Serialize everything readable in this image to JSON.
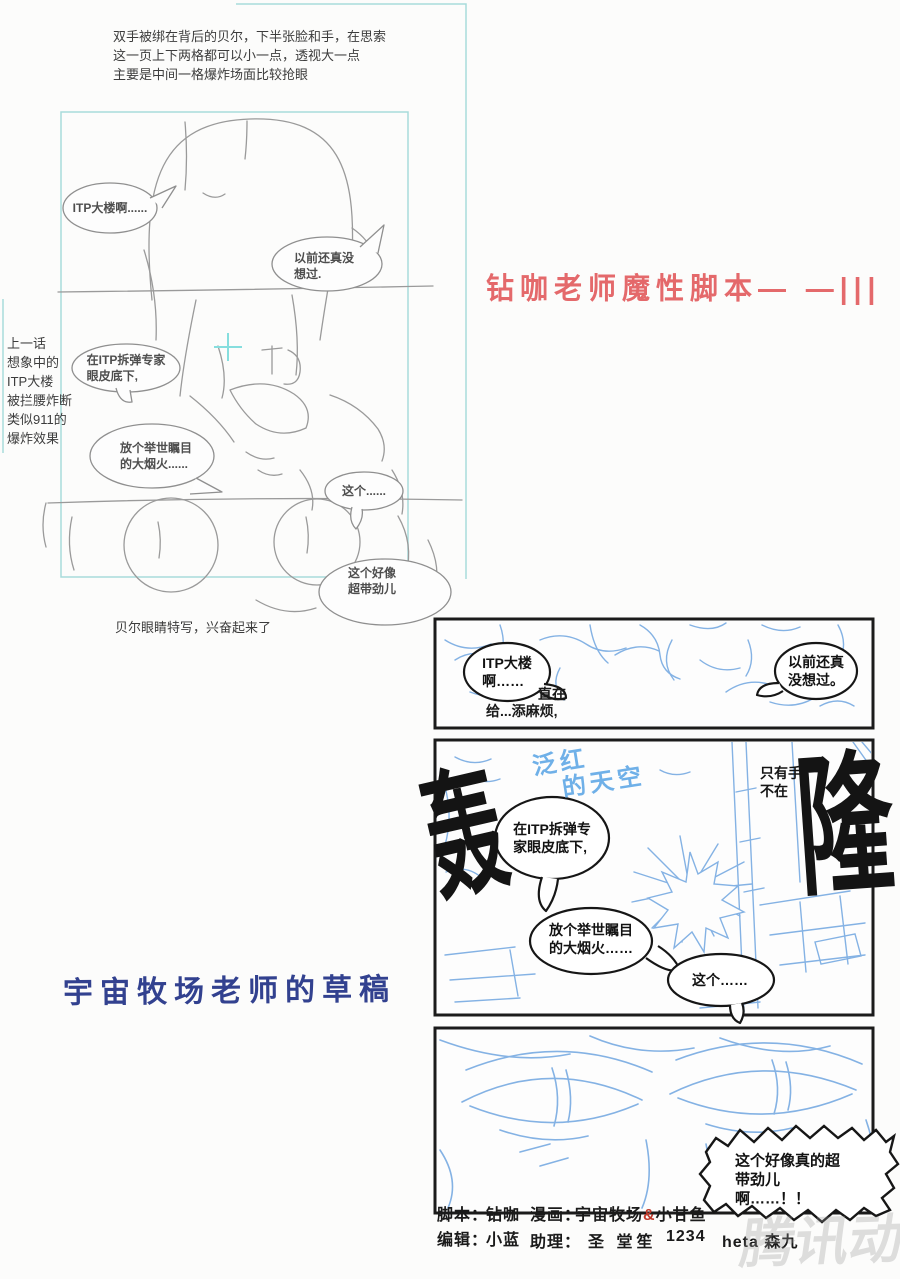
{
  "notes": {
    "top_lines": "双手被绑在背后的贝尔，下半张脸和手，在思索\n这一页上下两格都可以小一点，透视大一点\n主要是中间一格爆炸场面比较抢眼",
    "left_lines": "上一话\n想象中的\nITP大楼\n被拦腰炸断\n类似911的\n爆炸效果",
    "caption": "贝尔眼睛特写，兴奋起来了"
  },
  "titles": {
    "script_title": "钻咖老师魔性脚本— —|||",
    "draft_title": "宇宙牧场老师的草稿"
  },
  "storyboard": {
    "bubble_itp": "ITP大楼啊......",
    "bubble_never": "以前还真没\n想过.",
    "bubble_expert": "在ITP拆弹专家\n眼皮底下,",
    "bubble_firework": "放个举世瞩目\n的大烟火......",
    "bubble_this": "这个......",
    "bubble_cool": "这个好像\n超带劲儿"
  },
  "sketch": {
    "panel1": {
      "bubble_left": "ITP大楼\n啊……",
      "bubble_right": "以前还真\n没想过。",
      "partial_line1": "直在",
      "partial_line2": "给...添麻烦,"
    },
    "panel2": {
      "sfx_left": "轰",
      "sfx_right": "隆",
      "note_line1": "泛红",
      "note_line2": "的天空",
      "side_line1": "只有手",
      "side_line2": "不在",
      "bubble_expert": "在ITP拆弹专\n家眼皮底下,",
      "bubble_firework": "放个举世瞩目\n的大烟火……",
      "bubble_this": "这个……"
    },
    "panel3": {
      "bubble_excited": "这个好像真的超\n带劲儿啊……！！"
    }
  },
  "credits": {
    "script_label": "脚本：",
    "script_value": "钻咖",
    "comic_label": "漫画：",
    "comic_artist1": "宇宙牧场",
    "comic_amp": "&",
    "comic_artist2": "小甘鱼",
    "editor_label": "编辑：",
    "editor_value": "小蓝",
    "assistant_label": "助理：",
    "assistant_1": "圣 堂笙",
    "assistant_2": "1234",
    "assistant_3": "heta 森九"
  },
  "watermark": "腾讯动漫",
  "colors": {
    "title_red": "#e4696b",
    "draft_blue": "#32418f",
    "sketch_blue": "#84b2e4",
    "frame_cyan": "#a8dbdb"
  }
}
